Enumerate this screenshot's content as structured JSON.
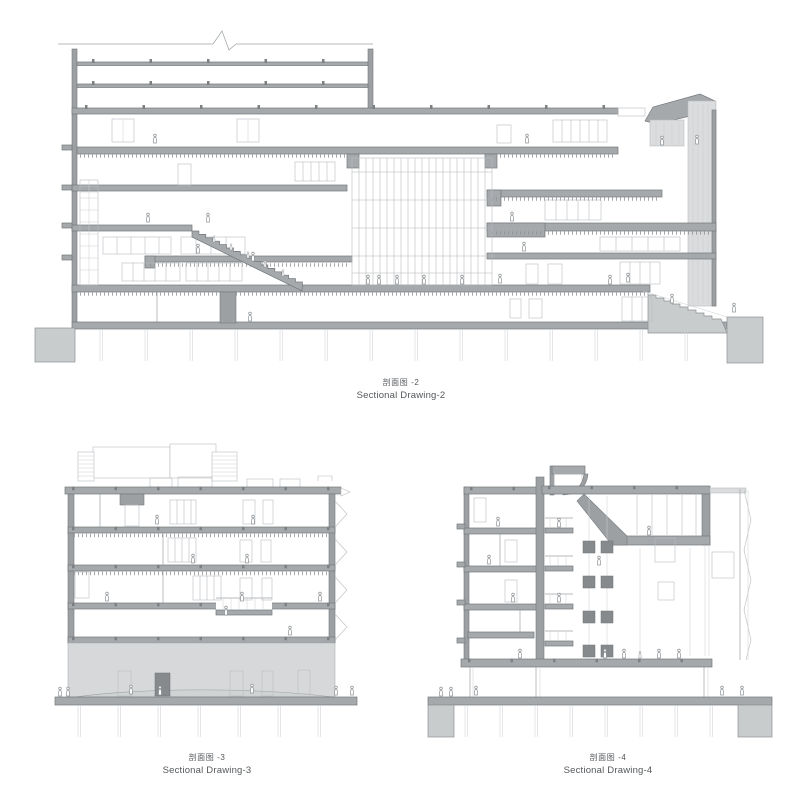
{
  "sheet": {
    "background": "#ffffff",
    "type_note": "architectural sectional drawings"
  },
  "captions": [
    {
      "id": "sectional-drawing-2",
      "zh": "剖面图 -2",
      "en": "Sectional Drawing-2"
    },
    {
      "id": "sectional-drawing-3",
      "zh": "剖面图 -3",
      "en": "Sectional Drawing-3"
    },
    {
      "id": "sectional-drawing-4",
      "zh": "剖面图 -4",
      "en": "Sectional Drawing-4"
    }
  ],
  "colors": {
    "background": "#ffffff",
    "slab_gray": "#a5a9ac",
    "cut_wall_gray": "#9ca0a3",
    "elevation_light_gray": "#dadcdd",
    "ground_mass_gray": "#c9cccd",
    "line_gray": "#9da1a4",
    "caption_text": "#54585b"
  }
}
